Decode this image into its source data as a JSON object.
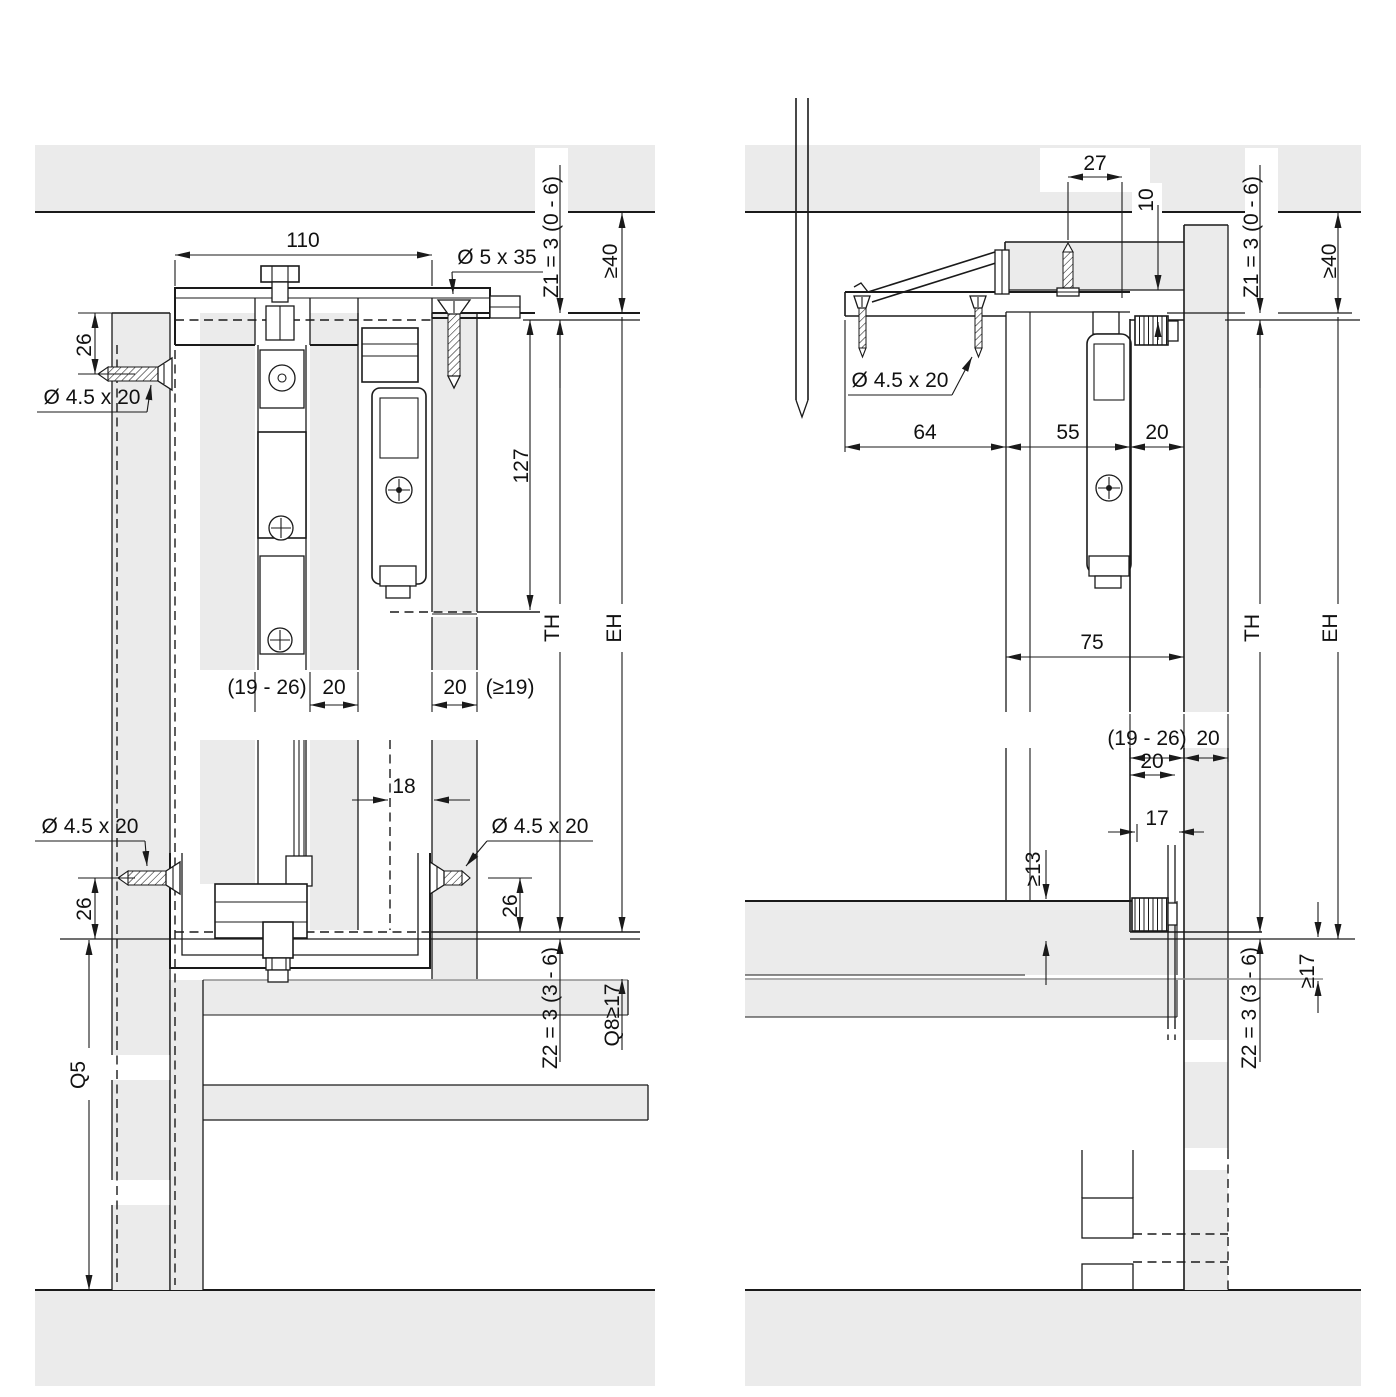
{
  "drawing": "sliding-door fitting installation cross-sections",
  "colors": {
    "panel": "#ebebeb",
    "line": "#1a1a1a",
    "lightline": "#909090",
    "bg": "#ffffff"
  },
  "left": {
    "d110": "110",
    "screw535": "Ø 5 x 35",
    "z1": "Z1 = 3 (0 - 6)",
    "ge40": "≥40",
    "d26top": "26",
    "screw45top": "Ø 4.5 x 20",
    "d127": "127",
    "th": "TH",
    "eh": "EH",
    "d1926": "(19 - 26)",
    "d20a": "20",
    "d20b": "20",
    "ge19": "(≥19)",
    "d18": "18",
    "screw45bl": "Ø 4.5 x 20",
    "screw45br": "Ø 4.5 x 20",
    "d26bl": "26",
    "d26br": "26",
    "z2": "Z2 = 3 (3 - 6)",
    "q8": "Q8≥17",
    "q5": "Q5"
  },
  "right": {
    "d27": "27",
    "d10": "10",
    "z1": "Z1 = 3 (0 - 6)",
    "ge40": "≥40",
    "screw45": "Ø 4.5 x 20",
    "d64": "64",
    "d55": "55",
    "d20top": "20",
    "d75": "75",
    "th": "TH",
    "eh": "EH",
    "d1926": "(19 - 26)",
    "d20wall": "20",
    "d20guide": "20",
    "d17": "17",
    "ge13": "≥13",
    "z2": "Z2 = 3 (3 - 6)",
    "ge17": "≥17"
  }
}
